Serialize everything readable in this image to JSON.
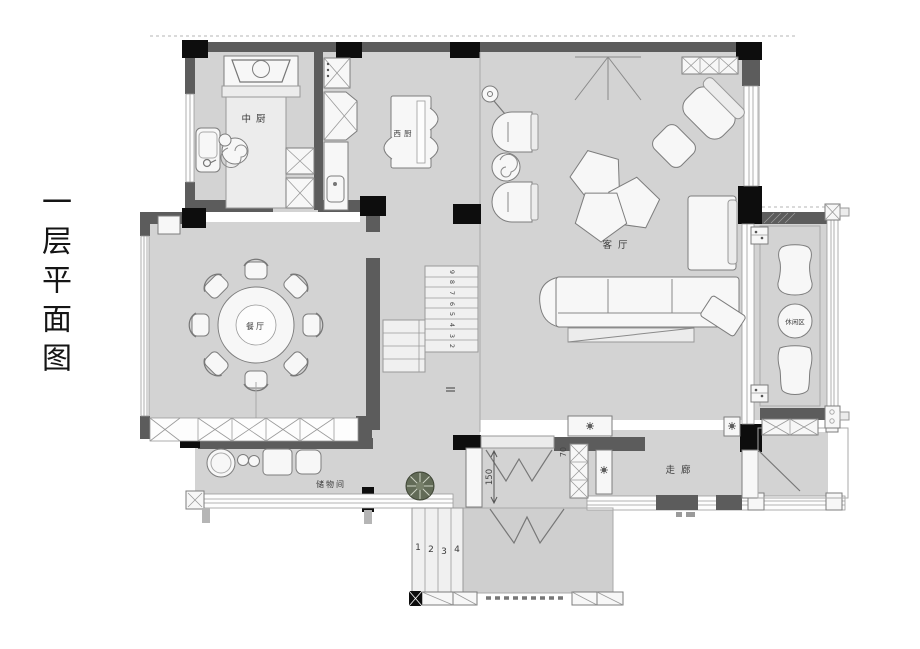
{
  "title": {
    "text": "一层平面图"
  },
  "rooms": {
    "kitchen_cn": {
      "label": "中厨"
    },
    "kitchen_west": {
      "label": "西厨"
    },
    "living": {
      "label": "客厅"
    },
    "dining": {
      "label": "餐厅"
    },
    "storage": {
      "label": "储物间"
    },
    "corridor": {
      "label": "走廊"
    },
    "leisure": {
      "label": "休闲区"
    }
  },
  "stairs": {
    "upper_steps": [
      "9",
      "8",
      "7",
      "6",
      "5",
      "4",
      "3",
      "2"
    ]
  },
  "entry_steps": [
    "1",
    "2",
    "3",
    "4"
  ],
  "dimensions": {
    "entry_opening": "150",
    "side_opening": "70"
  },
  "colors": {
    "wall": "#5c5c5c",
    "column": "#0d0d0d",
    "floor": "#d3d3d3",
    "accent_plant": "#626b57"
  }
}
